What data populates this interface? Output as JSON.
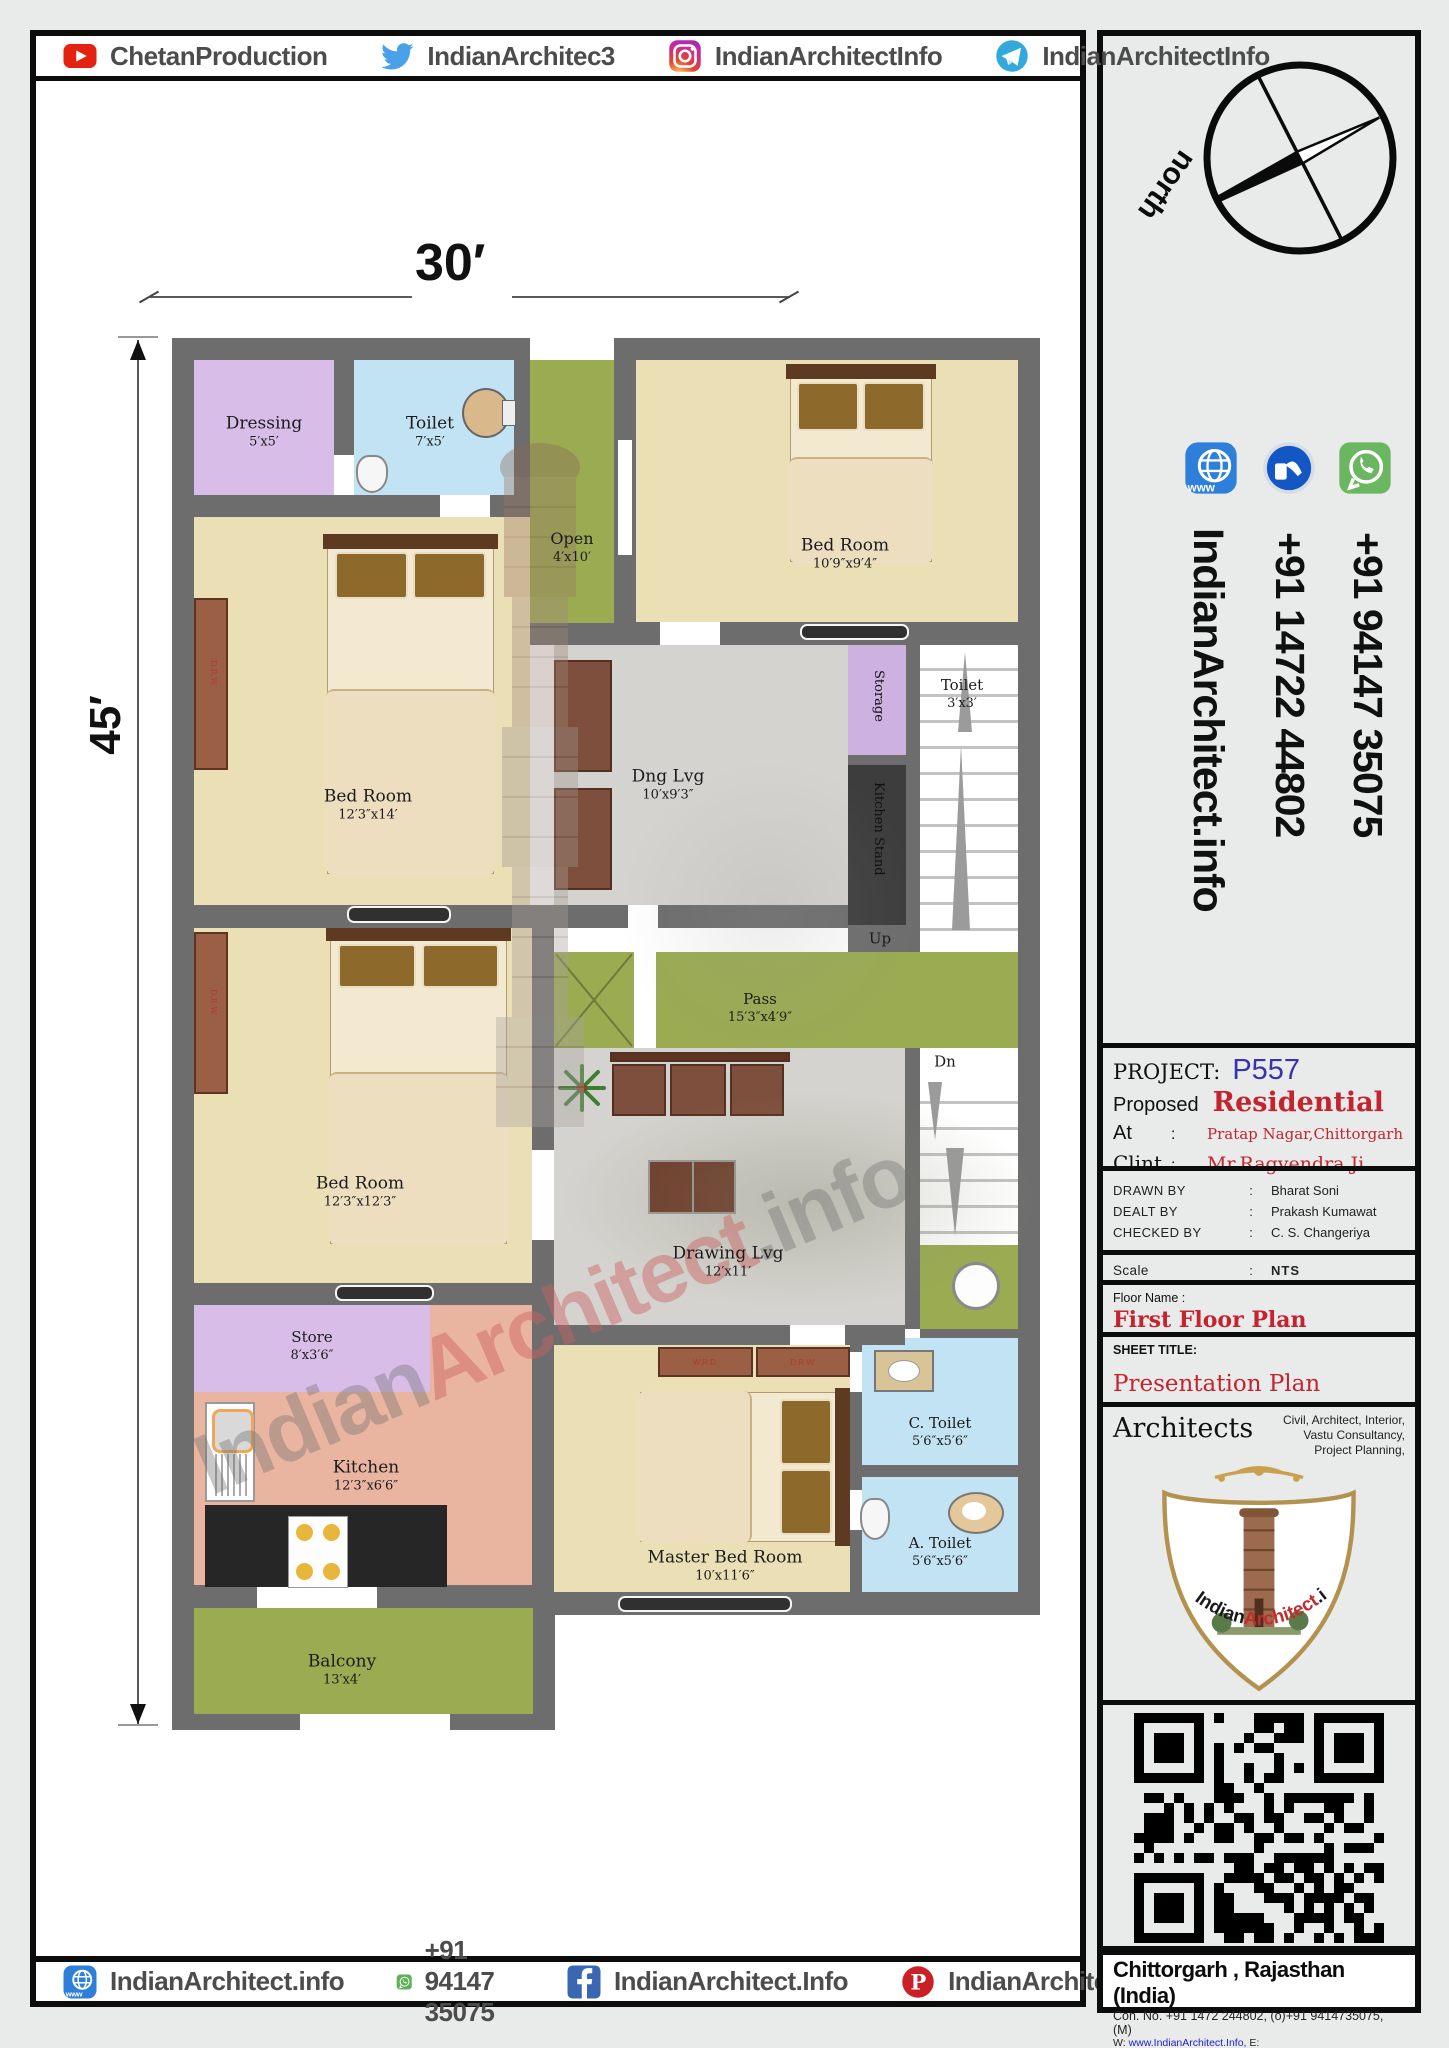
{
  "top_bar": {
    "items": [
      {
        "icon": "youtube-icon",
        "label": "ChetanProduction"
      },
      {
        "icon": "twitter-icon",
        "label": "IndianArchitec3"
      },
      {
        "icon": "instagram-icon",
        "label": "IndianArchitectInfo"
      },
      {
        "icon": "telegram-icon",
        "label": "IndianArchitectInfo"
      }
    ]
  },
  "bottom_bar": {
    "items": [
      {
        "icon": "website-icon",
        "label": "IndianArchitect.info"
      },
      {
        "icon": "whatsapp-icon",
        "label": "+91 94147 35075"
      },
      {
        "icon": "facebook-icon",
        "label": "IndianArchitect.Info"
      },
      {
        "icon": "pinterest-icon",
        "label": "IndianArchitectInfo"
      }
    ]
  },
  "sidebar": {
    "north_label": "north",
    "colon": ":",
    "vertical_contacts": {
      "website": "IndianArchitect.info",
      "phone_office": "+91 14722 44802",
      "phone_mobile": "+91 94147 35075"
    },
    "project": {
      "label": "PROJECT:",
      "number": "P557",
      "proposed_label": "Proposed",
      "type": "Residential",
      "at_label": "At",
      "at_value": "Pratap Nagar,Chittorgarh",
      "client_label": "Clint",
      "client_value": "Mr.Ragvendra Ji"
    },
    "team": [
      {
        "role": "DRAWN BY",
        "name": "Bharat Soni"
      },
      {
        "role": "DEALT BY",
        "name": "Prakash Kumawat"
      },
      {
        "role": "CHECKED BY",
        "name": "C. S. Changeriya"
      }
    ],
    "scale_label": "Scale",
    "scale_value": "NTS",
    "floor_label": "Floor Name :",
    "floor_value": "First Floor Plan",
    "sheet_label": "SHEET TITLE:",
    "sheet_value": "Presentation Plan",
    "architects": {
      "title": "Architects",
      "services": [
        "Civil, Architect, Interior,",
        "Vastu Consultancy,",
        "Project Planning,"
      ],
      "logo": {
        "black": "Indian",
        "red": "Architect",
        "suffix": ".info"
      }
    },
    "address": {
      "city": "Chittorgarh , Rajasthan (India)",
      "contact": "Con. No. +91 1472 244802, (o)+91 9414735075, (M)",
      "web_label": "W:",
      "website": "www.IndianArchitect.Info,",
      "email_label": "E:",
      "email": "IndianArchitect.Info@gmail.com"
    }
  },
  "plan": {
    "width_dim": "30′",
    "height_dim": "45′",
    "stairs": {
      "up": "Up",
      "dn": "Dn"
    },
    "watermark": {
      "black_a": "Indian",
      "red": "Architect",
      "black_b": ".info"
    },
    "wardrobe": {
      "a": "D.R.W.",
      "b": "W.R.D."
    },
    "rooms": [
      {
        "name": "Dressing",
        "dims": "5′x5′"
      },
      {
        "name": "Toilet",
        "dims": "7′x5′"
      },
      {
        "name": "Open",
        "dims": "4′x10′"
      },
      {
        "name": "Bed Room",
        "dims": "10′9″x9′4″"
      },
      {
        "name": "Storage",
        "dims": ""
      },
      {
        "name": "Toilet",
        "dims": "3′x3′"
      },
      {
        "name": "Kitchen Stand",
        "dims": ""
      },
      {
        "name": "Dng Lvg",
        "dims": "10′x9′3″"
      },
      {
        "name": "Bed Room",
        "dims": "12′3″x14′"
      },
      {
        "name": "Pass",
        "dims": "15′3″x4′9″"
      },
      {
        "name": "Bed Room",
        "dims": "12′3″x12′3″"
      },
      {
        "name": "Drawing Lvg",
        "dims": "12′x11′"
      },
      {
        "name": "Store",
        "dims": "8′x3′6″"
      },
      {
        "name": "Kitchen",
        "dims": "12′3″x6′6″"
      },
      {
        "name": "C. Toilet",
        "dims": "5′6″x5′6″"
      },
      {
        "name": "A. Toilet",
        "dims": "5′6″x5′6″"
      },
      {
        "name": "Master Bed Room",
        "dims": "10′x11′6″"
      },
      {
        "name": "Balcony",
        "dims": "13′x4′"
      }
    ]
  }
}
